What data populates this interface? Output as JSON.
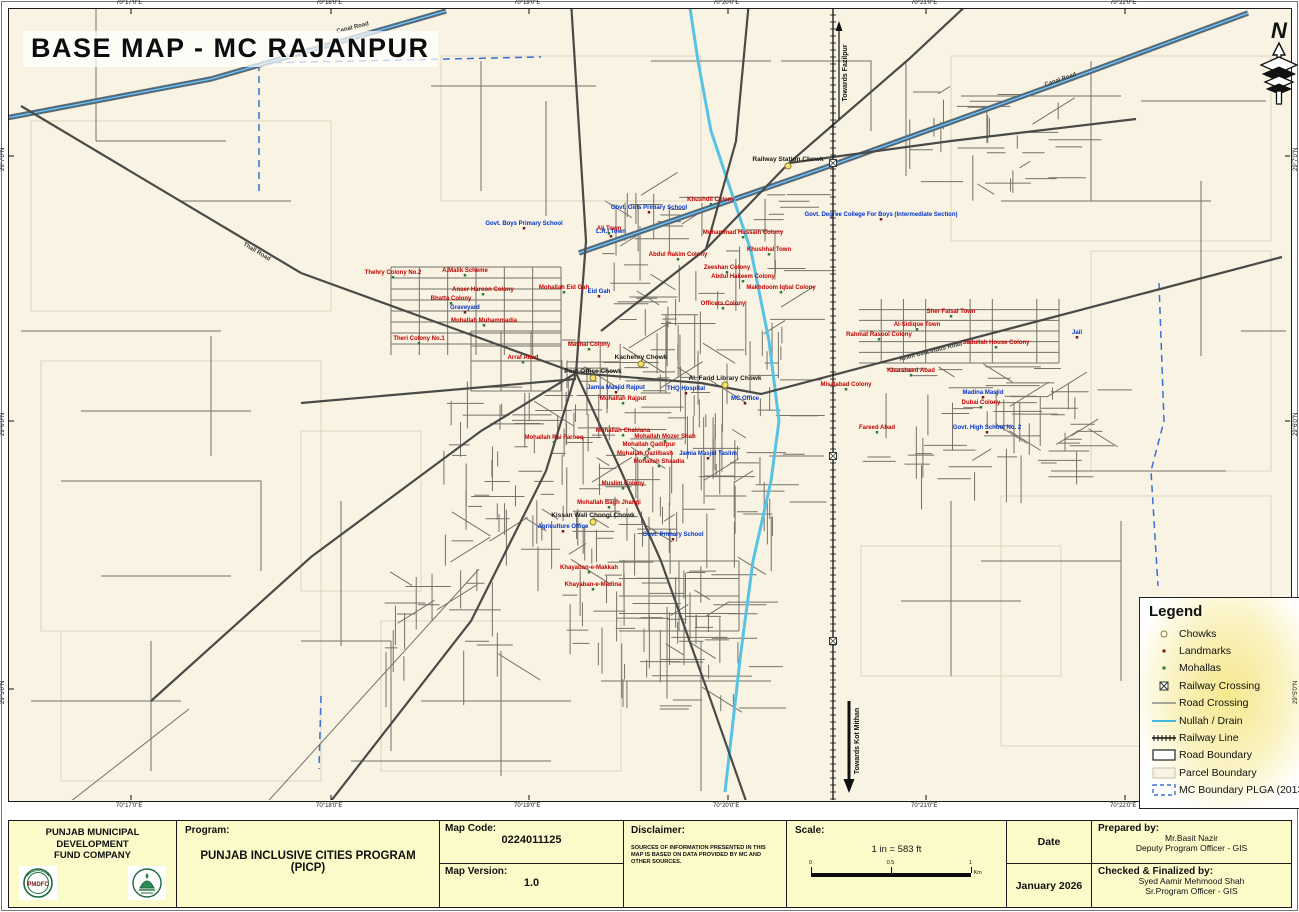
{
  "title": "BASE MAP - MC RAJANPUR",
  "north": {
    "letter": "N"
  },
  "frame": {
    "top_coords": [
      "70°17'0\"E",
      "70°18'0\"E",
      "70°19'0\"E",
      "70°20'0\"E",
      "70°21'0\"E",
      "70°22'0\"E"
    ],
    "bottom_coords": [
      "70°17'0\"E",
      "70°18'0\"E",
      "70°19'0\"E",
      "70°20'0\"E",
      "70°21'0\"E",
      "70°22'0\"E"
    ],
    "left_coords": [
      "29°7'0\"N",
      "29°6'0\"N",
      "29°5'0\"N"
    ],
    "right_coords": [
      "29°7'0\"N",
      "29°6'0\"N",
      "29°5'0\"N"
    ]
  },
  "railway_annotations": {
    "toward_top": "Towards Fazilpur",
    "toward_bottom": "Towards Kot Mithan"
  },
  "legend": {
    "title": "Legend",
    "items": [
      {
        "label": "Chowks",
        "symbol": "chowk"
      },
      {
        "label": "Landmarks",
        "symbol": "landmark"
      },
      {
        "label": "Mohallas",
        "symbol": "mohalla"
      },
      {
        "label": "Railway Crossing",
        "symbol": "railway-crossing"
      },
      {
        "label": "Road Crossing",
        "symbol": "road-crossing"
      },
      {
        "label": "Nullah / Drain",
        "symbol": "nullah"
      },
      {
        "label": "Railway Line",
        "symbol": "railway-line"
      },
      {
        "label": "Road Boundary",
        "symbol": "road-boundary"
      },
      {
        "label": "Parcel Boundary",
        "symbol": "parcel-boundary"
      },
      {
        "label": "MC Boundary PLGA (2013)",
        "symbol": "mc-boundary"
      }
    ]
  },
  "colors": {
    "map_bg": "#f8f3e2",
    "footer_bg": "#fbfac9",
    "mohalla_text": "#c40000",
    "landmark_text": "#0033cc",
    "chowk_text": "#1a1a1a",
    "road_minor": "#76716a",
    "road_major": "#4a4a48",
    "nullah": "#56c3e4",
    "canal": "#2f6f9f",
    "mc_boundary": "#3b6fd4",
    "parcel": "#dcd5be",
    "railway": "#111111"
  },
  "map_labels": [
    {
      "text": "Railway Station Chowk",
      "x": 787,
      "y": 160,
      "kind": "chowk"
    },
    {
      "text": "Kachehry Chowk",
      "x": 640,
      "y": 358,
      "kind": "chowk"
    },
    {
      "text": "Post Office Chowk",
      "x": 592,
      "y": 372,
      "kind": "chowk"
    },
    {
      "text": "Al. Farid Library Chowk",
      "x": 724,
      "y": 379,
      "kind": "chowk"
    },
    {
      "text": "Kissan Wali Chongi Chowk",
      "x": 592,
      "y": 516,
      "kind": "chowk"
    },
    {
      "text": "Govt. Degree College For Boys (Intermediate Section)",
      "x": 880,
      "y": 215,
      "kind": "landmark"
    },
    {
      "text": "Govt. Boys Primary School",
      "x": 523,
      "y": 224,
      "kind": "landmark"
    },
    {
      "text": "Govt. Girls Primary School",
      "x": 648,
      "y": 208,
      "kind": "landmark"
    },
    {
      "text": "L.R.I Town",
      "x": 610,
      "y": 232,
      "kind": "landmark"
    },
    {
      "text": "Jamia Masjid Rajput",
      "x": 615,
      "y": 388,
      "kind": "landmark"
    },
    {
      "text": "MC Office",
      "x": 744,
      "y": 399,
      "kind": "landmark"
    },
    {
      "text": "THQ Hospital",
      "x": 685,
      "y": 389,
      "kind": "landmark"
    },
    {
      "text": "Agriculture Office",
      "x": 562,
      "y": 527,
      "kind": "landmark"
    },
    {
      "text": "Jail",
      "x": 1076,
      "y": 333,
      "kind": "landmark"
    },
    {
      "text": "Govt. High School No. 2",
      "x": 986,
      "y": 428,
      "kind": "landmark"
    },
    {
      "text": "Madina Masjid",
      "x": 982,
      "y": 393,
      "kind": "landmark"
    },
    {
      "text": "Graveyard",
      "x": 464,
      "y": 308,
      "kind": "landmark"
    },
    {
      "text": "Eid Gah",
      "x": 598,
      "y": 292,
      "kind": "landmark"
    },
    {
      "text": "Jamia Masjid Taslim",
      "x": 707,
      "y": 454,
      "kind": "landmark"
    },
    {
      "text": "Govt. Primary School",
      "x": 672,
      "y": 535,
      "kind": "landmark"
    },
    {
      "text": "Thehry Colony No.2",
      "x": 392,
      "y": 273,
      "kind": "mohalla"
    },
    {
      "text": "A.Malik Scheme",
      "x": 464,
      "y": 271,
      "kind": "mohalla"
    },
    {
      "text": "Anser Haroon Colony",
      "x": 482,
      "y": 290,
      "kind": "mohalla"
    },
    {
      "text": "Bhatta Colony",
      "x": 450,
      "y": 299,
      "kind": "mohalla"
    },
    {
      "text": "Mohallah Muhammadia",
      "x": 483,
      "y": 321,
      "kind": "mohalla"
    },
    {
      "text": "Theri Colony No.1",
      "x": 418,
      "y": 339,
      "kind": "mohalla"
    },
    {
      "text": "Arraf Abad",
      "x": 522,
      "y": 358,
      "kind": "mohalla"
    },
    {
      "text": "Mohallah Eid Gah",
      "x": 563,
      "y": 288,
      "kind": "mohalla"
    },
    {
      "text": "Khushdil Colony",
      "x": 710,
      "y": 200,
      "kind": "mohalla"
    },
    {
      "text": "Ali Town",
      "x": 608,
      "y": 229,
      "kind": "mohalla"
    },
    {
      "text": "Muhammad Hussain Colony",
      "x": 742,
      "y": 233,
      "kind": "mohalla"
    },
    {
      "text": "Abdul Hakim Colony",
      "x": 677,
      "y": 255,
      "kind": "mohalla"
    },
    {
      "text": "Zeeshan Colony",
      "x": 726,
      "y": 268,
      "kind": "mohalla"
    },
    {
      "text": "Abdul Hakeem Colony",
      "x": 742,
      "y": 277,
      "kind": "mohalla"
    },
    {
      "text": "Khushhal Town",
      "x": 768,
      "y": 250,
      "kind": "mohalla"
    },
    {
      "text": "Makhdoom Iqbal Colony",
      "x": 780,
      "y": 288,
      "kind": "mohalla"
    },
    {
      "text": "Officers Colony",
      "x": 722,
      "y": 304,
      "kind": "mohalla"
    },
    {
      "text": "Mashal Colony",
      "x": 588,
      "y": 345,
      "kind": "mohalla"
    },
    {
      "text": "Mohallah Rajput",
      "x": 622,
      "y": 399,
      "kind": "mohalla"
    },
    {
      "text": "Mohallah Chaklana",
      "x": 622,
      "y": 431,
      "kind": "mohalla"
    },
    {
      "text": "Mohallah Mozer Shah",
      "x": 664,
      "y": 437,
      "kind": "mohalla"
    },
    {
      "text": "Mohallah Qadirpur",
      "x": 648,
      "y": 445,
      "kind": "mohalla"
    },
    {
      "text": "Mohallah Qazilbash",
      "x": 644,
      "y": 454,
      "kind": "mohalla"
    },
    {
      "text": "Mohallah Shaadia",
      "x": 658,
      "y": 462,
      "kind": "mohalla"
    },
    {
      "text": "Mohallah Rai Farooq",
      "x": 553,
      "y": 438,
      "kind": "mohalla"
    },
    {
      "text": "Muslim Colony",
      "x": 622,
      "y": 484,
      "kind": "mohalla"
    },
    {
      "text": "Mohallah Bagh Jhangi",
      "x": 608,
      "y": 503,
      "kind": "mohalla"
    },
    {
      "text": "Khayaban-e-Makkah",
      "x": 588,
      "y": 568,
      "kind": "mohalla"
    },
    {
      "text": "Khayaban-e-Madina",
      "x": 592,
      "y": 585,
      "kind": "mohalla"
    },
    {
      "text": "Sher Faisal Town",
      "x": 950,
      "y": 312,
      "kind": "mohalla"
    },
    {
      "text": "Al-Sidique Town",
      "x": 916,
      "y": 325,
      "kind": "mohalla"
    },
    {
      "text": "Rahmat Rasool Colony",
      "x": 878,
      "y": 335,
      "kind": "mohalla"
    },
    {
      "text": "Sadullah House Colony",
      "x": 995,
      "y": 343,
      "kind": "mohalla"
    },
    {
      "text": "Khursheed Abad",
      "x": 910,
      "y": 371,
      "kind": "mohalla"
    },
    {
      "text": "Dubai Colony",
      "x": 980,
      "y": 403,
      "kind": "mohalla"
    },
    {
      "text": "Fareed Abad",
      "x": 876,
      "y": 428,
      "kind": "mohalla"
    },
    {
      "text": "Misalabad Colony",
      "x": 845,
      "y": 385,
      "kind": "mohalla"
    },
    {
      "text": "Thall Road",
      "x": 255,
      "y": 252,
      "kind": "road",
      "rot": 31
    },
    {
      "text": "Canal Road",
      "x": 352,
      "y": 28,
      "kind": "road",
      "rot": -14
    },
    {
      "text": "Canal Road",
      "x": 1060,
      "y": 80,
      "kind": "road",
      "rot": -19
    },
    {
      "text": "Azam Bela Indus Road",
      "x": 930,
      "y": 352,
      "kind": "road",
      "rot": -14
    }
  ],
  "footer": {
    "org_name_line1": "PUNJAB MUNICIPAL DEVELOPMENT",
    "org_name_line2": "FUND COMPANY",
    "logo1": "PMDFC",
    "program_label": "Program:",
    "program_value": "PUNJAB INCLUSIVE CITIES PROGRAM (PICP)",
    "map_code_label": "Map Code:",
    "map_code_value": "0224011125",
    "map_version_label": "Map Version:",
    "map_version_value": "1.0",
    "disclaimer_label": "Disclaimer:",
    "disclaimer_text": "SOURCES OF INFORMATION PRESENTED IN THIS MAP IS BASED ON DATA PROVIDED BY MC AND OTHER SOURCES.",
    "scale_label": "Scale:",
    "scale_value": "1 in = 583 ft",
    "scale_ticks": [
      "0",
      "0.5",
      "1"
    ],
    "scale_unit": "Km",
    "date_label": "Date",
    "date_value": "January 2026",
    "prepared_label": "Prepared by:",
    "prepared_name": "Mr.Basit Nazir",
    "prepared_title": "Deputy Program Officer - GIS",
    "checked_label": "Checked & Finalized by:",
    "checked_name": "Syed Aamir Mehmood Shah",
    "checked_title": "Sr.Program Officer - GIS"
  }
}
